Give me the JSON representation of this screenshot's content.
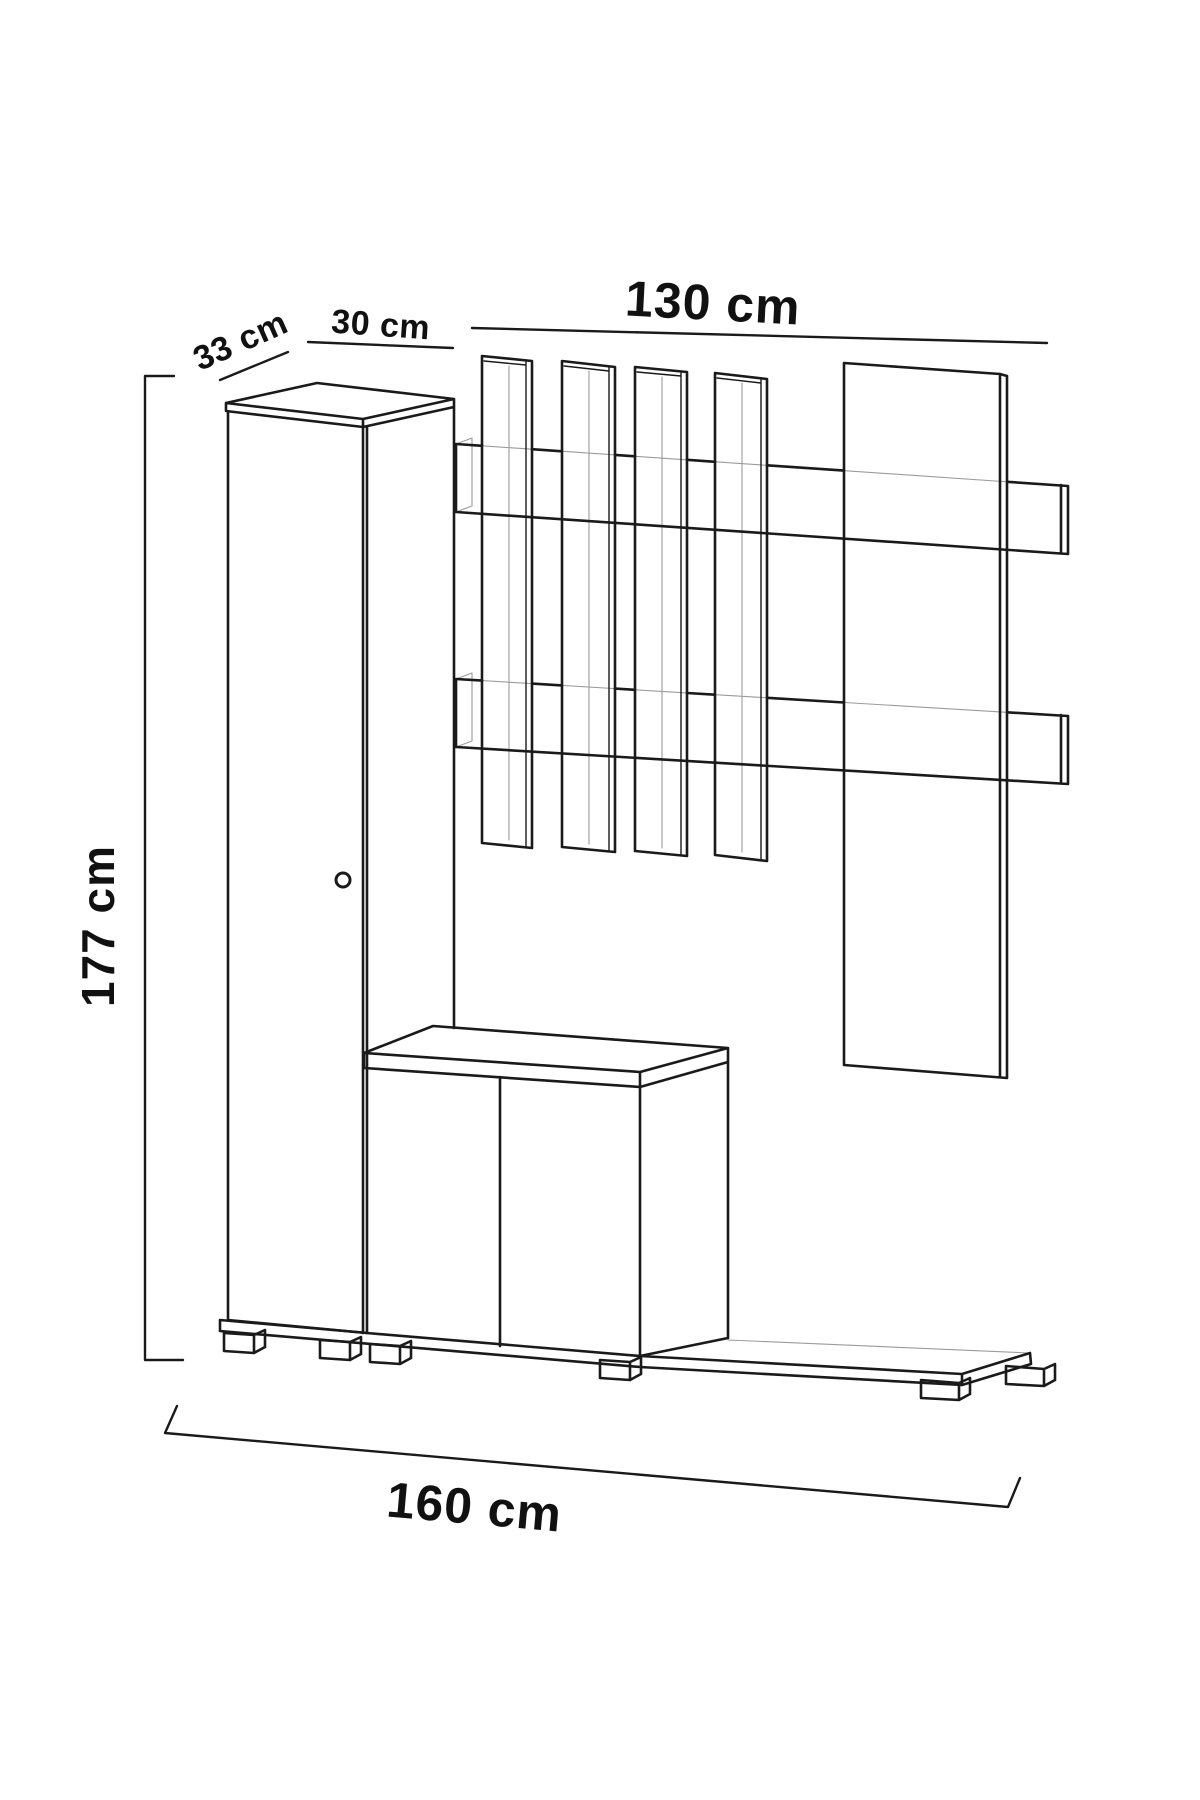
{
  "diagram": {
    "type": "isometric-furniture-dimension-drawing",
    "subject": "hallway unit with tall cabinet, shoe cabinet, coat-rack slat panel and base plinth",
    "labels": {
      "depth": "33 cm",
      "cabinet_width": "30 cm",
      "rack_width": "130 cm",
      "height": "177 cm",
      "total_width": "160 cm"
    },
    "colors": {
      "line": "#1a1a1a",
      "hidden_line": "#9b9b9b",
      "text": "#111111",
      "background": "#ffffff"
    }
  }
}
